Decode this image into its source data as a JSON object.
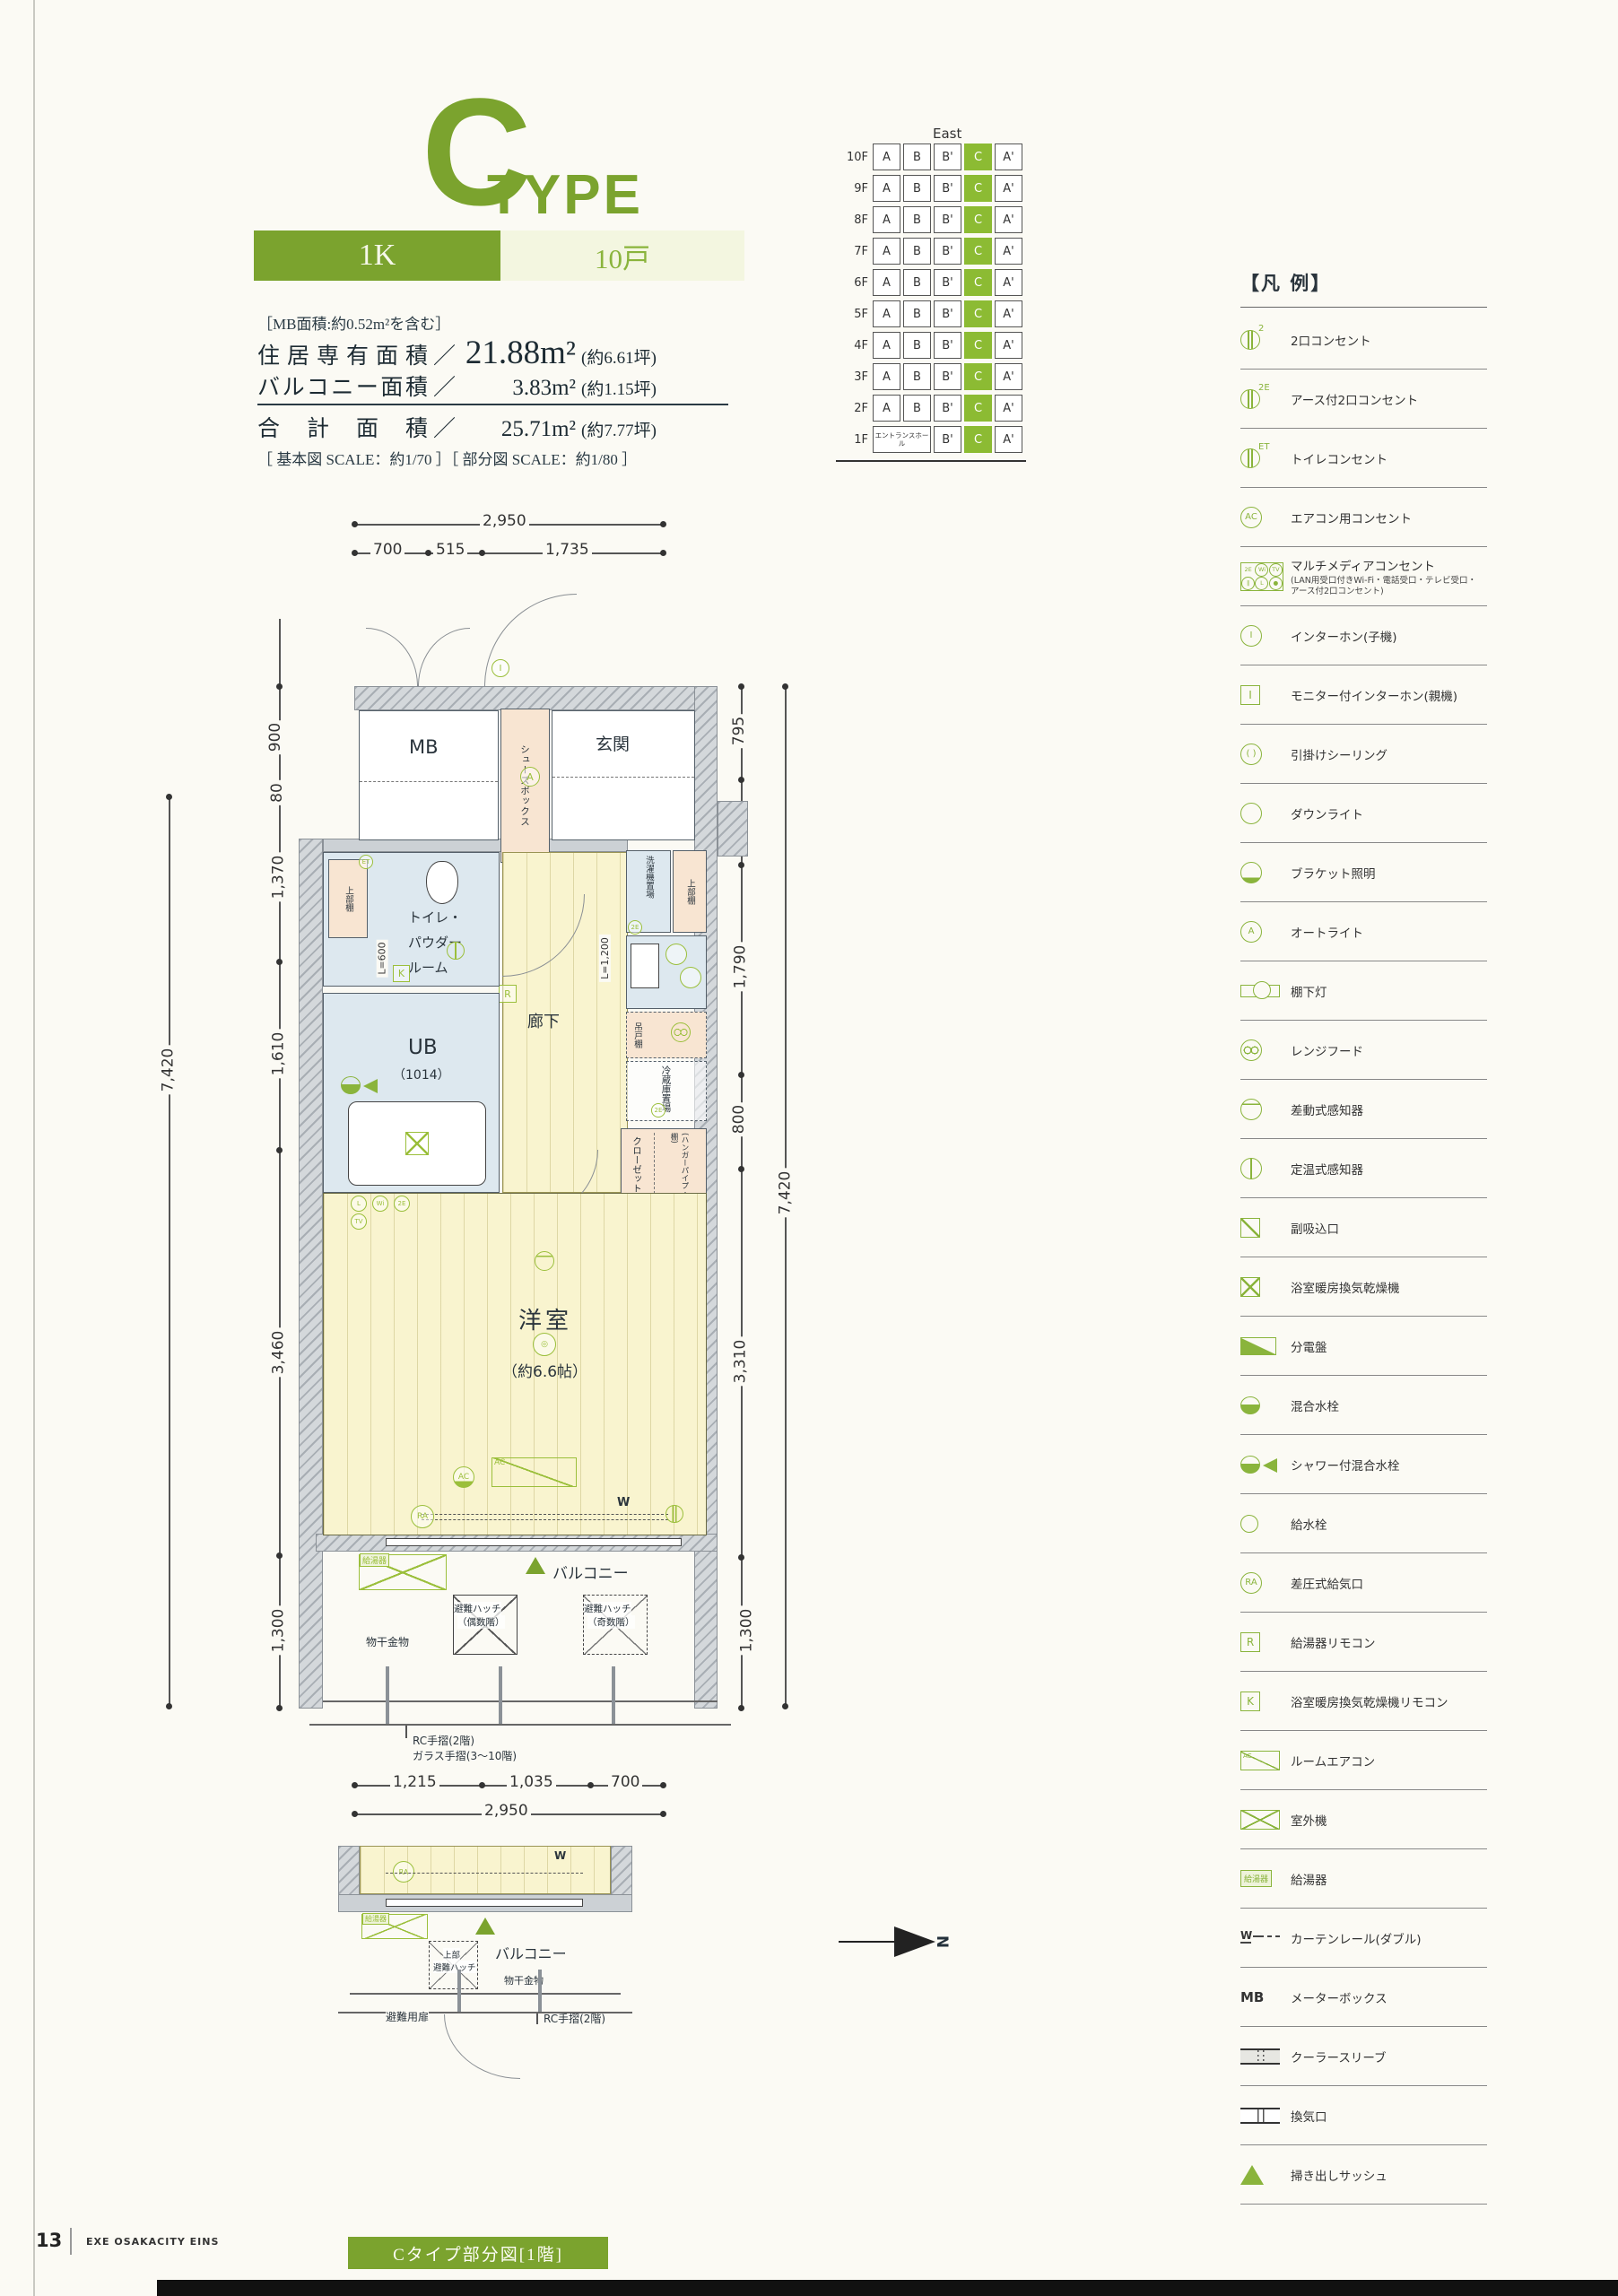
{
  "page": {
    "number": "13",
    "footer_brand": "EXE OSAKACITY EINS"
  },
  "header": {
    "type_letter": "C",
    "type_word": "TYPE",
    "layout_label": "1K",
    "units_label": "10戸",
    "mb_note": "［MB面積:約0.52m²を含む］",
    "areas": [
      {
        "label": "住居専有面積",
        "value": "21.88m²",
        "tsubo": "(約6.61坪)"
      },
      {
        "label": "バルコニー面積",
        "value": "3.83m²",
        "tsubo": "(約1.15坪)"
      },
      {
        "label": "合計面積",
        "value": "25.71m²",
        "tsubo": "(約7.77坪)"
      }
    ],
    "scale_note": "［ 基本図 SCALE：約1/70 ］［ 部分図 SCALE：約1/80 ］"
  },
  "position_grid": {
    "direction_label": "East",
    "highlight_column": "C",
    "rows": [
      {
        "floor": "10F",
        "cells": [
          "A",
          "B",
          "B'",
          "C",
          "A'"
        ]
      },
      {
        "floor": "9F",
        "cells": [
          "A",
          "B",
          "B'",
          "C",
          "A'"
        ]
      },
      {
        "floor": "8F",
        "cells": [
          "A",
          "B",
          "B'",
          "C",
          "A'"
        ]
      },
      {
        "floor": "7F",
        "cells": [
          "A",
          "B",
          "B'",
          "C",
          "A'"
        ]
      },
      {
        "floor": "6F",
        "cells": [
          "A",
          "B",
          "B'",
          "C",
          "A'"
        ]
      },
      {
        "floor": "5F",
        "cells": [
          "A",
          "B",
          "B'",
          "C",
          "A'"
        ]
      },
      {
        "floor": "4F",
        "cells": [
          "A",
          "B",
          "B'",
          "C",
          "A'"
        ]
      },
      {
        "floor": "3F",
        "cells": [
          "A",
          "B",
          "B'",
          "C",
          "A'"
        ]
      },
      {
        "floor": "2F",
        "cells": [
          "A",
          "B",
          "B'",
          "C",
          "A'"
        ]
      },
      {
        "floor": "1F",
        "cells": [
          "エントランスホール",
          "B'",
          "C",
          "A'"
        ]
      }
    ]
  },
  "legend": {
    "title": "【凡 例】",
    "items": [
      {
        "icon": "outlet",
        "sup": "2",
        "label": "2口コンセント"
      },
      {
        "icon": "outlet",
        "sup": "2E",
        "label": "アース付2口コンセント"
      },
      {
        "icon": "outlet",
        "sup": "ET",
        "label": "トイレコンセント"
      },
      {
        "icon": "circle",
        "glyph": "AC",
        "label": "エアコン用コンセント"
      },
      {
        "icon": "multimedia",
        "parts": [
          "2E",
          "Wi",
          "TV",
          "‖",
          "L",
          "●"
        ],
        "label": "マルチメディアコンセント",
        "sub": "(LAN用受口付きWi-Fi・電話受口・テレビ受口・アース付2口コンセント)"
      },
      {
        "icon": "circle",
        "glyph": "I",
        "label": "インターホン(子機)"
      },
      {
        "icon": "square",
        "glyph": "I",
        "label": "モニター付インターホン(親機)"
      },
      {
        "icon": "circle",
        "glyph": "( )",
        "label": "引掛けシーリング"
      },
      {
        "icon": "circle",
        "label": "ダウンライト"
      },
      {
        "icon": "bracket",
        "label": "ブラケット照明"
      },
      {
        "icon": "circle",
        "glyph": "A",
        "label": "オートライト"
      },
      {
        "icon": "shelf-light",
        "label": "棚下灯"
      },
      {
        "icon": "hood",
        "label": "レンジフード"
      },
      {
        "icon": "diff",
        "label": "差動式感知器"
      },
      {
        "icon": "fixed",
        "label": "定温式感知器"
      },
      {
        "icon": "diag-sq",
        "label": "副吸込口"
      },
      {
        "icon": "x-sq",
        "label": "浴室暖房換気乾燥機"
      },
      {
        "icon": "dist",
        "label": "分電盤"
      },
      {
        "icon": "mixer",
        "label": "混合水栓"
      },
      {
        "icon": "shower",
        "label": "シャワー付混合水栓"
      },
      {
        "icon": "tap",
        "label": "給水栓"
      },
      {
        "icon": "circle",
        "glyph": "RA",
        "label": "差圧式給気口"
      },
      {
        "icon": "square",
        "glyph": "R",
        "label": "給湯器リモコン"
      },
      {
        "icon": "square",
        "glyph": "K",
        "label": "浴室暖房換気乾燥機リモコン"
      },
      {
        "icon": "rac",
        "glyph": "AC",
        "label": "ルームエアコン"
      },
      {
        "icon": "x-rect",
        "label": "室外機"
      },
      {
        "icon": "heater",
        "glyph": "給湯器",
        "label": "給湯器"
      },
      {
        "icon": "rail",
        "glyph": "W",
        "label": "カーテンレール(ダブル)"
      },
      {
        "icon": "text",
        "glyph": "MB",
        "label": "メーターボックス"
      },
      {
        "icon": "sleeve",
        "label": "クーラースリーブ"
      },
      {
        "icon": "vent",
        "label": "換気口"
      },
      {
        "icon": "tri",
        "label": "掃き出しサッシュ"
      }
    ]
  },
  "floor_plan": {
    "dims_top": {
      "total": "2,950",
      "parts": [
        "700",
        "515",
        "1,735"
      ]
    },
    "dims_left": [
      "900",
      "80",
      "1,370",
      "1,610",
      "3,460",
      "1,300"
    ],
    "dims_left_total": "7,420",
    "dims_right": [
      "795",
      "725",
      "1,790",
      "800",
      "3,310",
      "1,300"
    ],
    "dims_right_total": "7,420",
    "dims_bottom": {
      "parts": [
        "1,215",
        "1,035",
        "700"
      ],
      "total": "2,950"
    },
    "labels": {
      "mb": "MB",
      "shoes": "シューズボックス",
      "genkan": "玄関",
      "washer": "洗濯機置場",
      "shelf_upper_left": "上部棚",
      "shelf_upper_right": "上部棚",
      "toilet_l1": "トイレ・",
      "toilet_l2": "パウダー",
      "toilet_l3": "ルーム",
      "ub": "UB",
      "ub_size": "（1014）",
      "hall": "廊下",
      "l600": "L=600",
      "l1200": "L=1,200",
      "hanging_shelf": "吊戸棚",
      "fridge": "冷蔵庫置場",
      "closet": "クローゼット",
      "closet_note": "(ハンガーパイプ・枕棚)",
      "room": "洋室",
      "room_size": "（約6.6帖）",
      "balcony": "バルコニー",
      "hatch_even_l1": "避難ハッチ",
      "hatch_even_l2": "（偶数階）",
      "hatch_odd_l1": "避難ハッチ",
      "hatch_odd_l2": "（奇数階）",
      "monohoshi": "物干金物",
      "heater": "給湯器",
      "rc_note": "RC手摺(2階)",
      "glass_note": "ガラス手摺(3〜10階)"
    },
    "symbols": {
      "ac": "AC",
      "ra": "RA",
      "w": "W",
      "i": "I",
      "a": "A",
      "r": "R",
      "k": "K",
      "et": "ET",
      "e2": "2E",
      "tv": "TV",
      "wi": "Wi",
      "l": "L",
      "north": "N"
    }
  },
  "partial_plan": {
    "caption": "Cタイプ部分図[1階]",
    "labels": {
      "balcony": "バルコニー",
      "upper_hatch_l1": "上部",
      "upper_hatch_l2": "避難ハッチ",
      "monohoshi": "物干金物",
      "escape_door": "避難用扉",
      "rc_note": "RC手摺(2階)",
      "heater": "給湯器",
      "ra": "RA",
      "w": "W"
    }
  }
}
